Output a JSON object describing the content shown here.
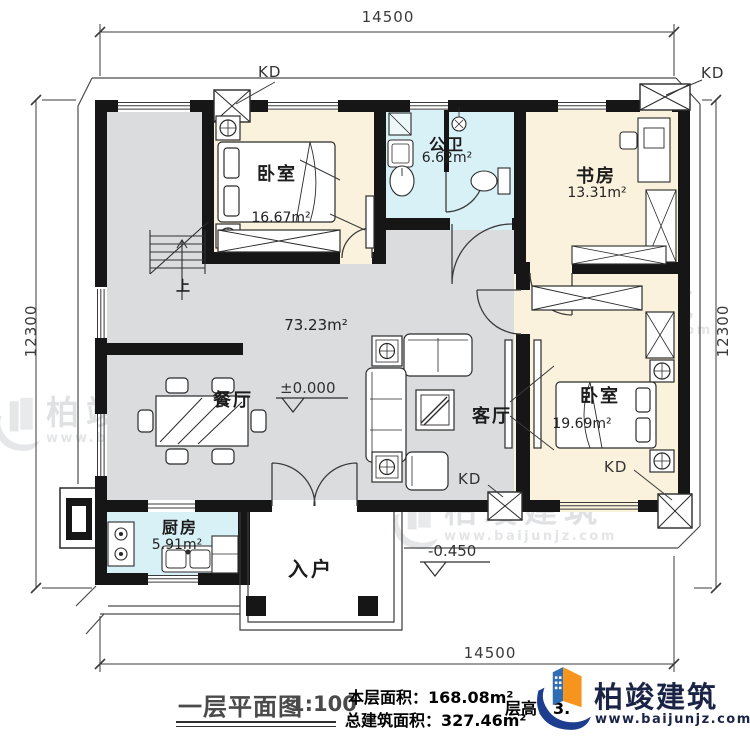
{
  "dimensions": {
    "top": "14500",
    "bottom": "14500",
    "left": "12300",
    "right": "12300"
  },
  "rooms": {
    "bedroom1": {
      "name": "卧室",
      "area": "16.67m²"
    },
    "bathroom": {
      "name": "公卫",
      "area": "6.62m²"
    },
    "study": {
      "name": "书房",
      "area": "13.31m²"
    },
    "open_area": {
      "area": "73.23m²"
    },
    "dining": {
      "name": "餐厅"
    },
    "living": {
      "name": "客厅"
    },
    "bedroom2": {
      "name": "卧室",
      "area": "19.69m²"
    },
    "kitchen": {
      "name": "厨房",
      "area": "5.91m²"
    },
    "entry": {
      "name": "入户"
    }
  },
  "annotations": {
    "window_tag": "KD",
    "stairs_up": "上",
    "level_main": "±0.000",
    "level_entry": "-0.450"
  },
  "titleblock": {
    "title": "一层平面图",
    "scale": "1:100",
    "floor_area": "本层面积：168.08m²",
    "total_area": "总建筑面积：327.46m²",
    "height_note": "层高：3."
  },
  "brand": {
    "name": "柏竣建筑",
    "site": "www.baijunjz.com"
  },
  "watermark": {
    "name": "柏竣建筑",
    "site": "www.baijunjz.com"
  }
}
